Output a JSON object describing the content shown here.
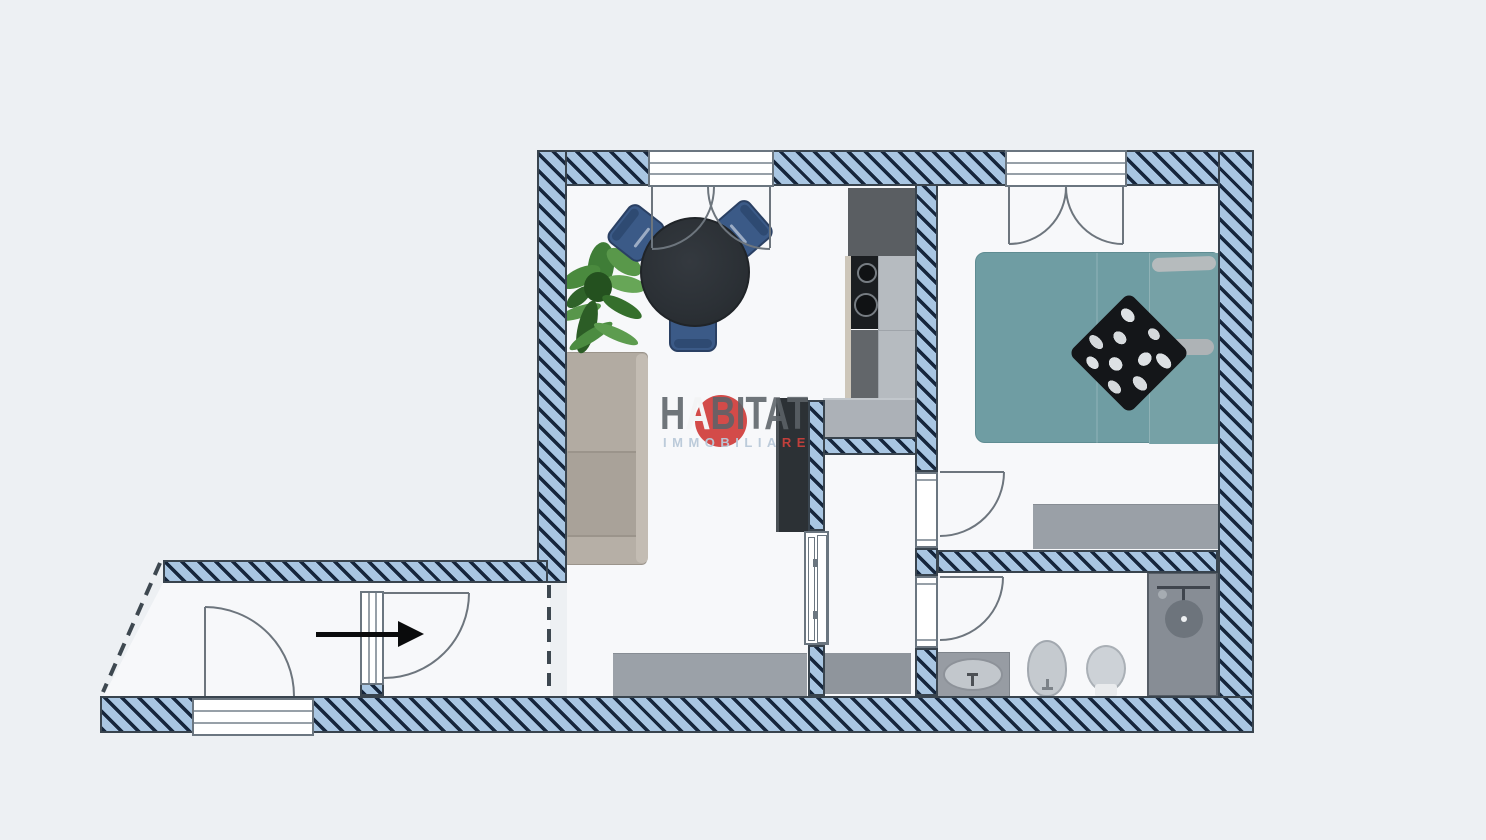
{
  "watermark": {
    "brand_h": "H",
    "brand_a": "A",
    "brand_rest": "BITAT",
    "tagline_main": "IMMOBILIA",
    "tagline_accent": "RE"
  },
  "icons": {
    "entrance_arrow": "solid-right-arrow",
    "shower_head": "circle-with-drain",
    "cooktop_burners": "two-rings"
  },
  "palette": {
    "background": "#edf0f3",
    "floor": "#f7f8fa",
    "wall_fill": "#a9c6e2",
    "wall_stripe": "#16263c",
    "wall_outline": "#39444e",
    "frame_border": "#6b7680",
    "door_arc": "#6d757d",
    "dashed_line": "#3e4850",
    "arrow_black": "#0a0b0c",
    "bed_teal": "#6f9da3",
    "pillow_dark": "#141619",
    "pillow_light": "#dde1e4",
    "chair_blue": "#3b5a87",
    "table_dark": "#2d3237",
    "sofa_taupe": "#b2aba2",
    "plant_green": "#4c8a3e",
    "wardrobe_dark": "#2c3135",
    "kitchen_dark": "#5a5e62",
    "cooktop_black": "#1b1e21",
    "counter_light": "#b6bbc0",
    "counter_gray": "#9ba1a8",
    "fixture_gray": "#c5cacf",
    "shower_gray": "#878d95",
    "watermark_red": "#cf3c3a",
    "watermark_gray": "#5c6268",
    "watermark_blue": "#b8c8d8"
  }
}
